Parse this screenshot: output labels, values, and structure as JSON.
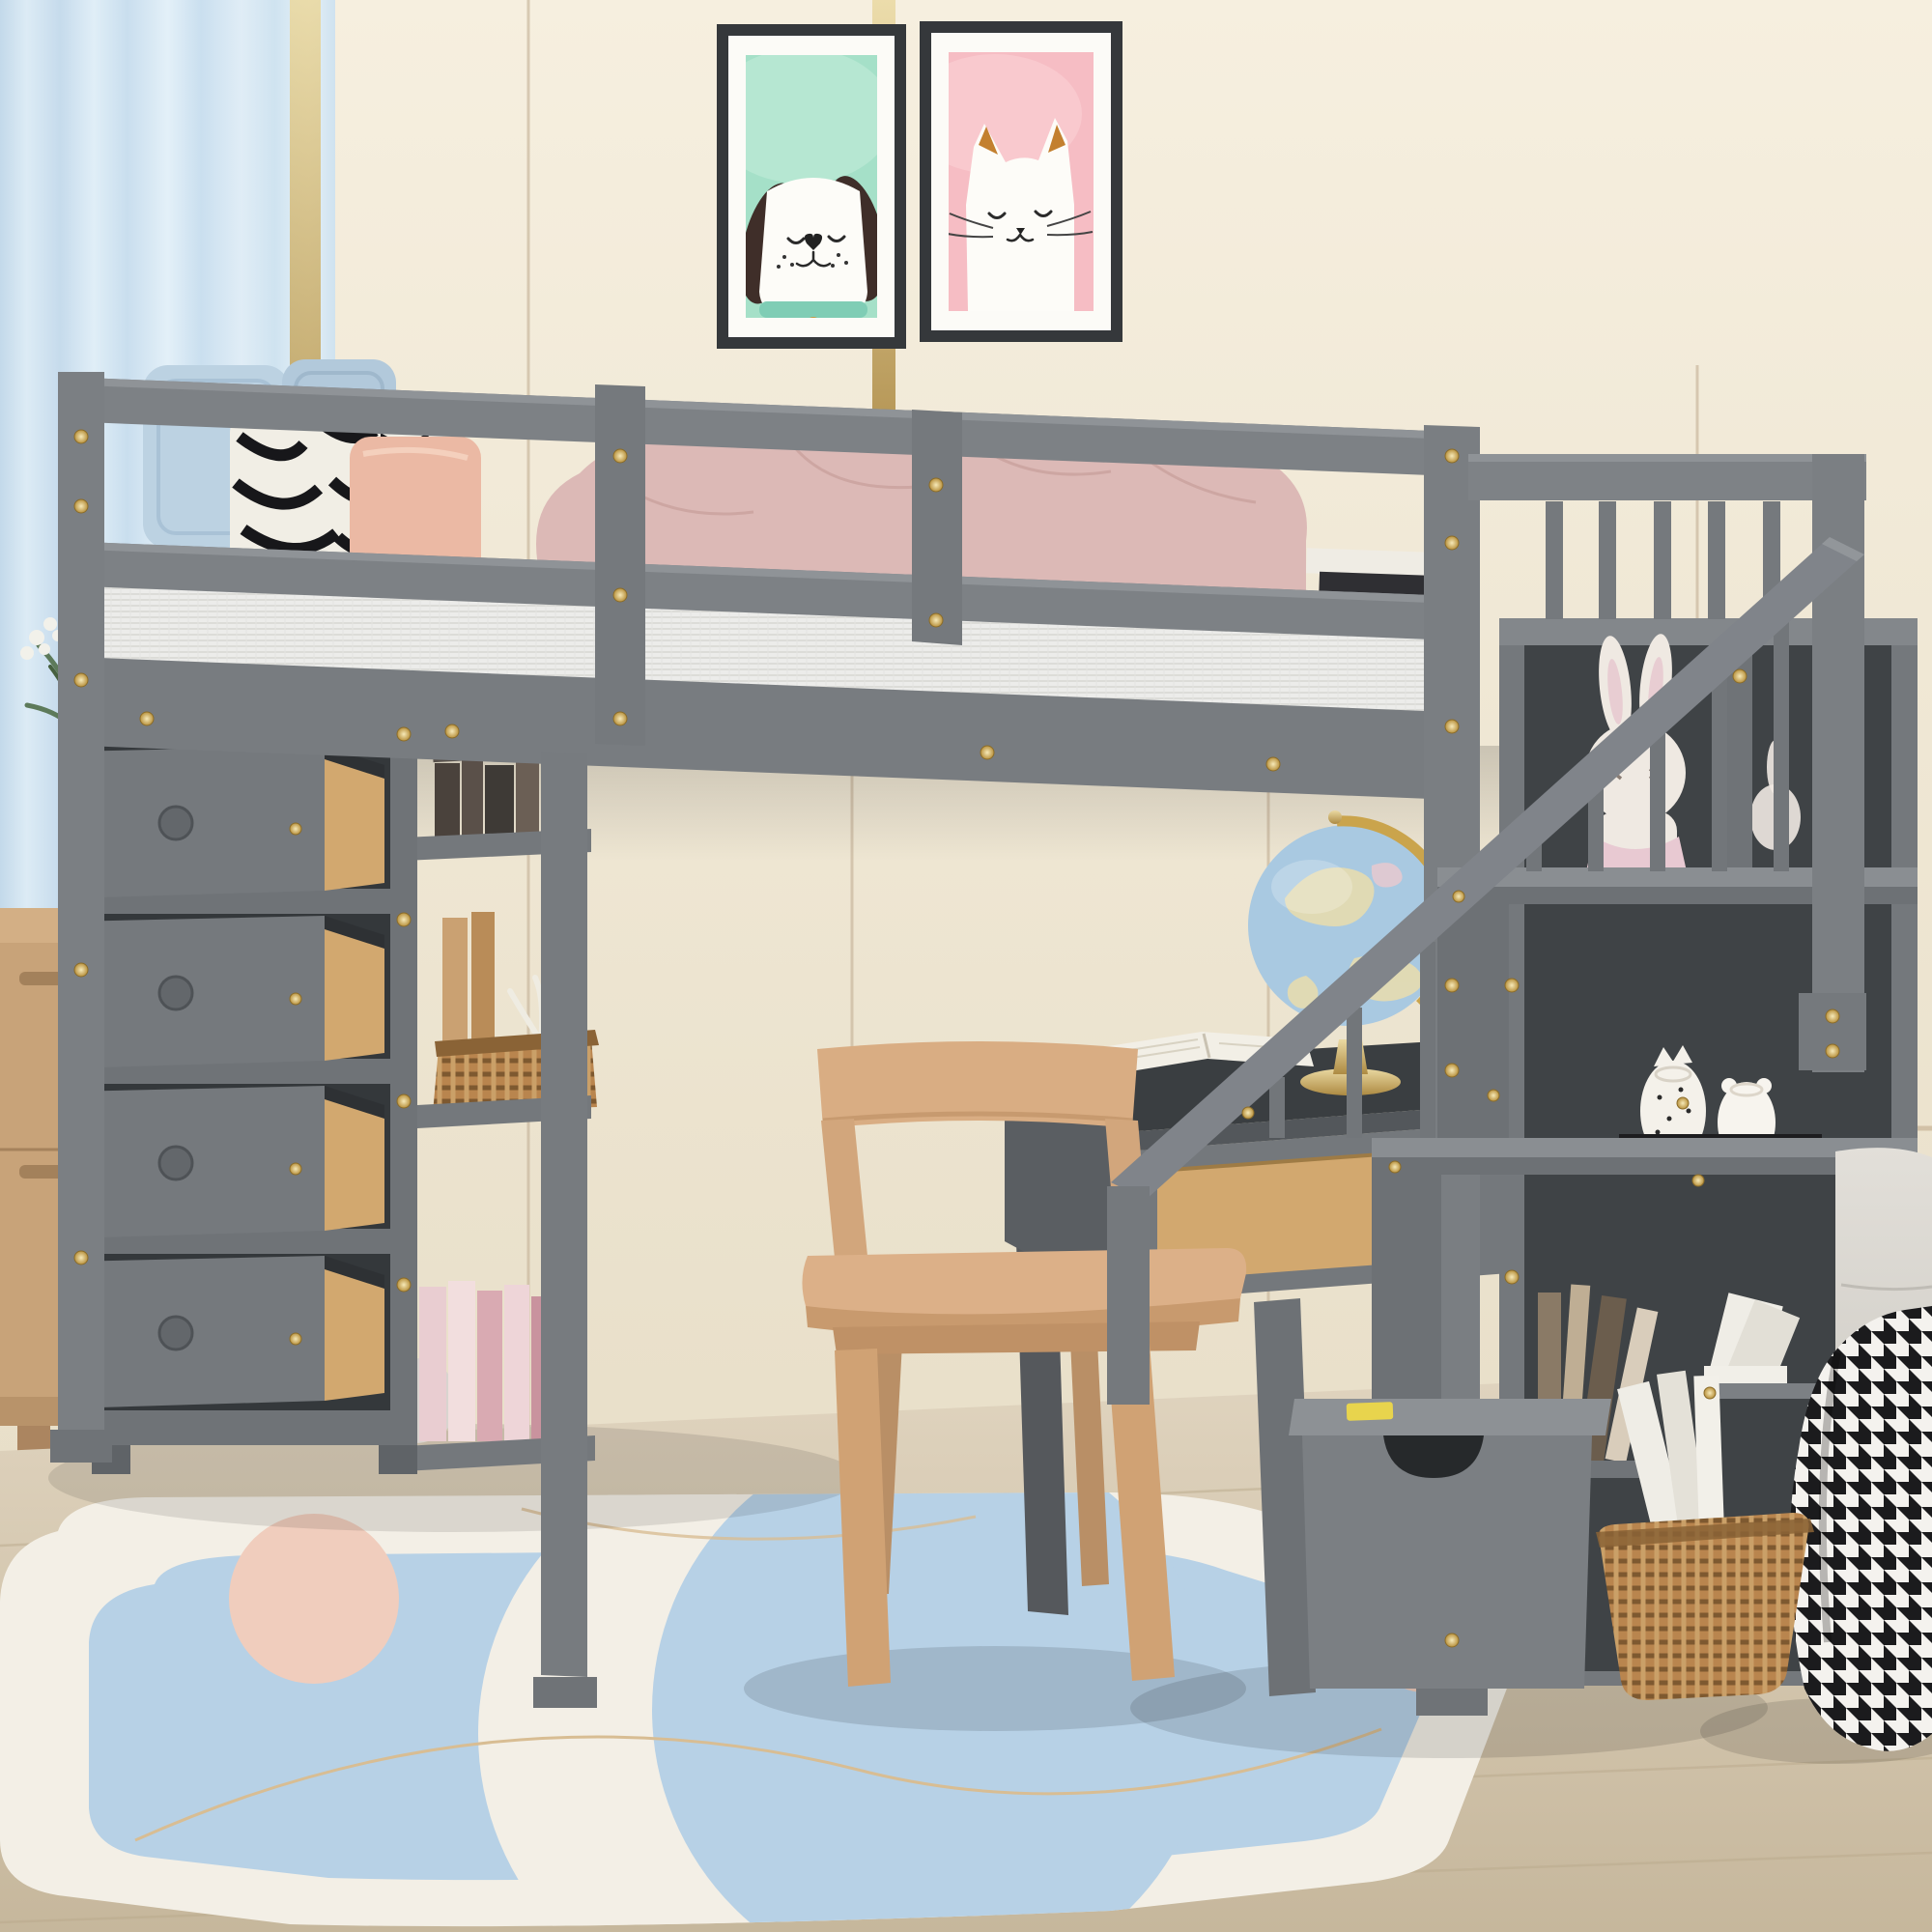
{
  "meta": {
    "type": "product-photo",
    "alt": "Gray wooden loft bed with storage staircase, four open drawers, open shelves, built-in desk and chair in a pastel children's bedroom"
  },
  "palette": {
    "wall_top": "#f6efdf",
    "wall_bottom": "#e4dac2",
    "panel_line": "#c6b39a",
    "curtain_blue": "#cfe2ef",
    "gold_trim": "#cdbd93",
    "frame_dark": "#35383b",
    "poster_mint": "#a5e0c8",
    "poster_pink": "#f6bdc4",
    "dog_ear_brown": "#3f2e29",
    "cat_ear_orange": "#c3802f",
    "bed_gray": "#7d8185",
    "bed_gray_light": "#8d9196",
    "bed_gray_dark": "#6a6e72",
    "interior_dark": "#3f4346",
    "screw_gold": "#d9b863",
    "mattress_white": "#ececea",
    "pillow_blue": "#bcd2e2",
    "pillow_salmon": "#ebb9a4",
    "zebra_black": "#17171a",
    "blanket_pink": "#dcb9b6",
    "chair_wood": "#d8ab80",
    "drawer_wood": "#d2a86f",
    "dresser_wood": "#c8a379",
    "floor_wood": "#d6c9b2",
    "rug_white": "#f3efe6",
    "rug_blue": "#b7d1e6",
    "rug_pink": "#f0cdbd",
    "rug_tan": "#d8bd93",
    "globe_blue": "#a9c9e1",
    "globe_gold": "#c9a44a",
    "basket_brown": "#b9854e",
    "bench_gray": "#d9d6d0",
    "houndstooth_black": "#1b1b1d",
    "plush_white": "#efe9e2",
    "vase_blue": "#4f80a6",
    "plant_green": "#5d7a5a"
  },
  "scene": {
    "wall": {
      "label": "cream paneled wall with thin vertical trim lines"
    },
    "curtain": {
      "label": "light blue curtain with gold edge strip"
    },
    "posters": {
      "dog": {
        "label": "framed dog art print, mint background, white dog with dark floppy ears and teal collar"
      },
      "cat": {
        "label": "framed cat art print, pink background, white cat with orange inner ears"
      }
    },
    "loft_bed": {
      "label": "gray wood loft bed with guard rails and gold screw accents"
    },
    "bedding": {
      "label": "white mattress, two blue pillows, two zebra pillows, one salmon pillow, pink blanket, books on mattress"
    },
    "drawer_tower": {
      "label": "four open storage drawers with round knobs",
      "drawer_count": 4
    },
    "shelf_unit": {
      "label": "open shelves with books, wicker basket, coral decor, pink books and plush",
      "shelf_count": 3
    },
    "desk": {
      "label": "built-in gray desk with wood drawer, globe and open book"
    },
    "chair": {
      "label": "natural wood chair"
    },
    "staircase": {
      "label": "storage staircase with railing, cubbies, bunny plush, ceramic jars, books and bottom drawer",
      "step_count": 3
    },
    "dresser": {
      "label": "light wood dresser with blue glass vase, greenery and gold ornament"
    },
    "rug": {
      "label": "white and blue area rug with crescent moon and pink circles"
    },
    "floor": {
      "label": "light wood plank floor"
    },
    "bench": {
      "label": "beige upholstered bench with gold leg and black-white houndstooth throw"
    },
    "floor_basket": {
      "label": "wicker basket holding white books"
    }
  }
}
